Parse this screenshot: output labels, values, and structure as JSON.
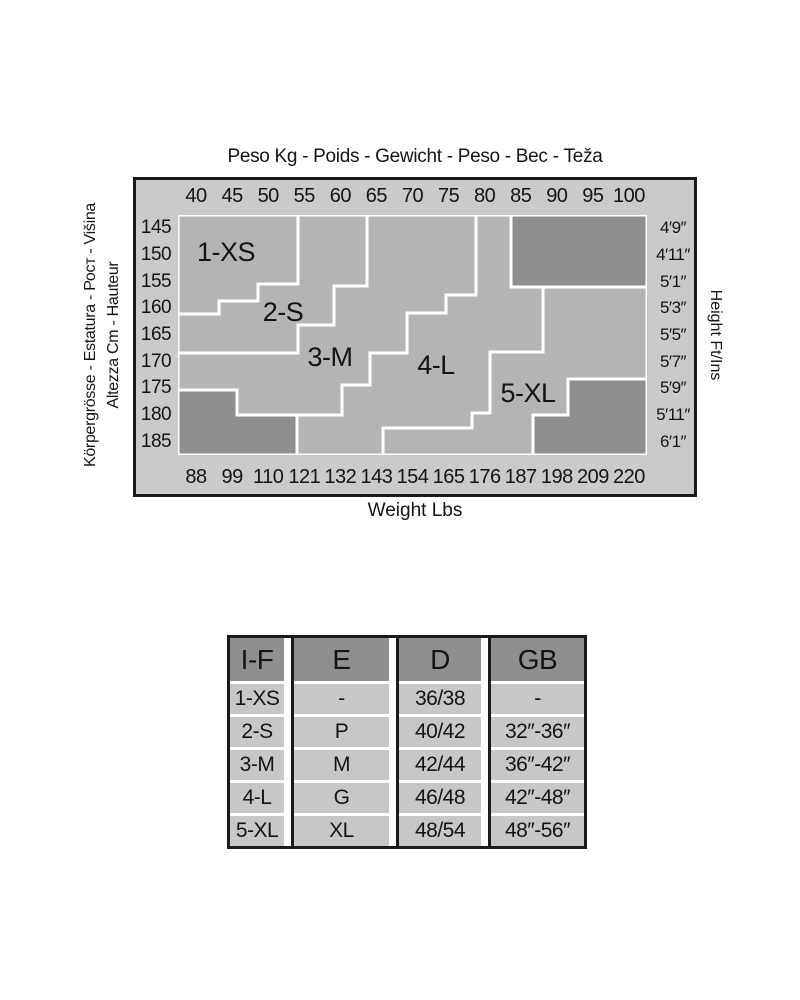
{
  "colors": {
    "page_bg": "#ffffff",
    "chart_outer_bg": "#cacaca",
    "region_fill": "#b4b4b4",
    "excluded_fill": "#8f8f8f",
    "boundary_line": "#ffffff",
    "border": "#1a1a1a",
    "table_header_bg": "#8f8f8f",
    "table_cell_bg": "#c7c7c7",
    "text": "#141414"
  },
  "chart": {
    "title_top": "Peso Kg - Poids - Gewicht - Peso - Вес - Teža",
    "left_axis_line_outer": "Körpergrösse - Estatura - Рост - Višina",
    "left_axis_line_inner": "Altezza Cm - Hauteur",
    "right_axis_label": "Height Ft/Ins",
    "bottom_axis_label": "Weight Lbs"
  },
  "chart_data": {
    "type": "heatmap",
    "title": "Peso Kg - Poids - Gewicht - Peso - Вес - Teža",
    "xlabel_top": "Weight Kg",
    "xlabel_bottom": "Weight Lbs",
    "ylabel_left": "Height Cm",
    "ylabel_right": "Height Ft/Ins",
    "x_top_ticks_kg": [
      "40",
      "45",
      "50",
      "55",
      "60",
      "65",
      "70",
      "75",
      "80",
      "85",
      "90",
      "95",
      "100"
    ],
    "x_bottom_ticks_lbs": [
      "88",
      "99",
      "110",
      "121",
      "132",
      "143",
      "154",
      "165",
      "176",
      "187",
      "198",
      "209",
      "220"
    ],
    "y_left_ticks_cm": [
      "145",
      "150",
      "155",
      "160",
      "165",
      "170",
      "175",
      "180",
      "185"
    ],
    "y_right_ticks_ftin": [
      "4′9″",
      "4′11″",
      "5′1″",
      "5′3″",
      "5′5″",
      "5′7″",
      "5′9″",
      "5′11″",
      "6′1″"
    ],
    "grid": "off",
    "legend": "labels inside regions",
    "plot_size": [
      469,
      240
    ],
    "regions": [
      {
        "label": "1-XS",
        "label_xy": [
          48,
          36
        ],
        "points": [
          [
            0,
            0
          ],
          [
            120,
            0
          ],
          [
            120,
            69
          ],
          [
            80,
            69
          ],
          [
            80,
            86
          ],
          [
            41,
            86
          ],
          [
            41,
            99
          ],
          [
            0,
            99
          ]
        ]
      },
      {
        "label": "2-S",
        "label_xy": [
          105,
          96
        ],
        "points": [
          [
            0,
            99
          ],
          [
            41,
            99
          ],
          [
            41,
            86
          ],
          [
            80,
            86
          ],
          [
            80,
            69
          ],
          [
            120,
            69
          ],
          [
            120,
            0
          ],
          [
            189,
            0
          ],
          [
            189,
            71
          ],
          [
            156,
            71
          ],
          [
            156,
            110
          ],
          [
            120,
            110
          ],
          [
            120,
            138
          ],
          [
            0,
            138
          ]
        ]
      },
      {
        "label": "3-M",
        "label_xy": [
          152,
          141
        ],
        "points": [
          [
            0,
            138
          ],
          [
            120,
            138
          ],
          [
            120,
            110
          ],
          [
            156,
            110
          ],
          [
            156,
            71
          ],
          [
            189,
            71
          ],
          [
            189,
            0
          ],
          [
            298,
            0
          ],
          [
            298,
            80
          ],
          [
            268,
            80
          ],
          [
            268,
            98
          ],
          [
            229,
            98
          ],
          [
            229,
            138
          ],
          [
            192,
            138
          ],
          [
            192,
            170
          ],
          [
            164,
            170
          ],
          [
            164,
            200
          ],
          [
            59,
            200
          ],
          [
            59,
            175
          ],
          [
            0,
            175
          ]
        ]
      },
      {
        "label": "4-L",
        "label_xy": [
          258,
          149
        ],
        "points": [
          [
            298,
            0
          ],
          [
            333,
            0
          ],
          [
            333,
            72
          ],
          [
            365,
            72
          ],
          [
            365,
            137
          ],
          [
            312,
            137
          ],
          [
            312,
            198
          ],
          [
            294,
            198
          ],
          [
            294,
            213
          ],
          [
            205,
            213
          ],
          [
            205,
            240
          ],
          [
            119,
            240
          ],
          [
            119,
            200
          ],
          [
            164,
            200
          ],
          [
            164,
            170
          ],
          [
            192,
            170
          ],
          [
            192,
            138
          ],
          [
            229,
            138
          ],
          [
            229,
            98
          ],
          [
            268,
            98
          ],
          [
            268,
            80
          ],
          [
            298,
            80
          ]
        ]
      },
      {
        "label": "5-XL",
        "label_xy": [
          350,
          177
        ],
        "points": [
          [
            365,
            72
          ],
          [
            469,
            72
          ],
          [
            469,
            164
          ],
          [
            390,
            164
          ],
          [
            390,
            200
          ],
          [
            355,
            200
          ],
          [
            355,
            240
          ],
          [
            205,
            240
          ],
          [
            205,
            213
          ],
          [
            294,
            213
          ],
          [
            294,
            198
          ],
          [
            312,
            198
          ],
          [
            312,
            137
          ],
          [
            365,
            137
          ]
        ]
      }
    ],
    "excluded_zones": [
      {
        "name": "top-right",
        "points": [
          [
            333,
            0
          ],
          [
            469,
            0
          ],
          [
            469,
            72
          ],
          [
            333,
            72
          ]
        ]
      },
      {
        "name": "bottom-left",
        "points": [
          [
            0,
            175
          ],
          [
            59,
            175
          ],
          [
            59,
            200
          ],
          [
            119,
            200
          ],
          [
            119,
            240
          ],
          [
            0,
            240
          ]
        ]
      },
      {
        "name": "bottom-right",
        "points": [
          [
            390,
            164
          ],
          [
            469,
            164
          ],
          [
            469,
            240
          ],
          [
            355,
            240
          ],
          [
            355,
            200
          ],
          [
            390,
            200
          ]
        ]
      }
    ]
  },
  "table": {
    "col_widths": [
      54,
      95,
      82,
      93
    ],
    "columns": [
      {
        "header": "I-F",
        "cells": [
          "1-XS",
          "2-S",
          "3-M",
          "4-L",
          "5-XL"
        ]
      },
      {
        "header": "E",
        "cells": [
          "-",
          "P",
          "M",
          "G",
          "XL"
        ]
      },
      {
        "header": "D",
        "cells": [
          "36/38",
          "40/42",
          "42/44",
          "46/48",
          "48/54"
        ]
      },
      {
        "header": "GB",
        "cells": [
          "-",
          "32″-36″",
          "36″-42″",
          "42″-48″",
          "48″-56″"
        ]
      }
    ]
  }
}
